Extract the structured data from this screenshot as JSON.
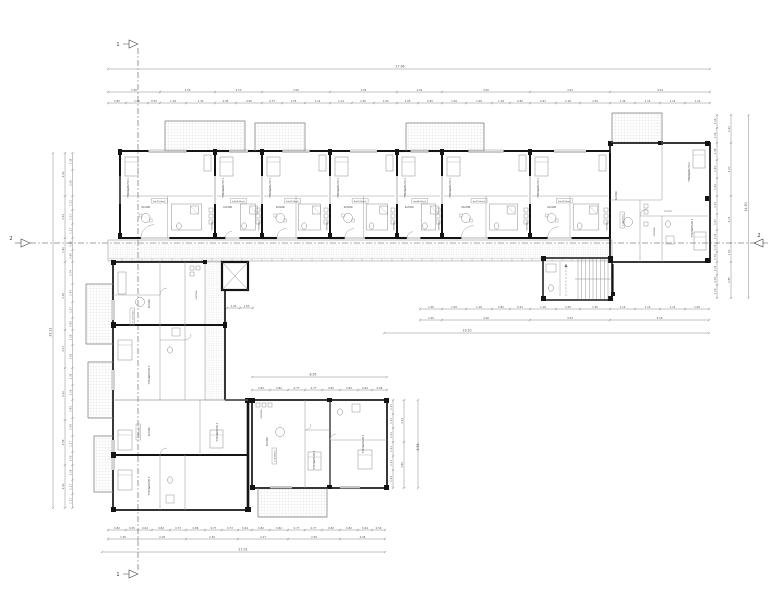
{
  "title": "apartment-building-floor-plan",
  "colors": {
    "wall": "#141414",
    "line": "#8b8b8b",
    "thin": "#ababab",
    "hatch": "#c9c9c9",
    "dim": "#7a7a7a",
    "dim_text": "#555555",
    "label": "#3f3f3f",
    "section": "#444444",
    "bg": "#ffffff"
  },
  "markers": {
    "section1": "1",
    "section2": "2"
  },
  "rooms": {
    "bedroom1": "ΥΠΝΟΔΩΜΑΤΙΟ 1",
    "bedroom2": "ΥΠΝΟΔΩΜΑΤΙΟ 2",
    "living": "ΣΑΛΟΝΙ",
    "kitchen": "ΚΟΥΖΙΝΑ",
    "bath": "ΛΟΥΤΡΟ",
    "wc": "WC",
    "hall": "ΧΩΛ"
  },
  "top_units": [
    {
      "bedroom": "ΥΠΝΟΔΩΜΑΤΙΟ 1",
      "living": "ΣΑΛΟΝΙ",
      "kitchen": "ΚΟΥΖΙΝΑ",
      "area": "Ε=75.50m2"
    },
    {
      "bedroom": "ΥΠΝΟΔΩΜΑΤΙΟ 1",
      "living": "ΣΑΛΟΝΙ",
      "kitchen": "ΚΟΥΖΙΝΑ",
      "area": "Ε=58.35m2"
    },
    {
      "bedroom": "ΥΠΝΟΔΩΜΑΤΙΟ 1",
      "living": "ΣΑΛΟΝΙ",
      "kitchen": "ΚΟΥΖΙΝΑ",
      "area": "Ε=76.50m2"
    },
    {
      "bedroom": "ΥΠΝΟΔΩΜΑΤΙΟ 1",
      "living": "ΣΑΛΟΝΙ",
      "kitchen": "ΚΟΥΖΙΝΑ",
      "area": "Ε=76.50m2"
    },
    {
      "bedroom": "ΥΠΝΟΔΩΜΑΤΙΟ 1",
      "living": "ΣΑΛΟΝΙ",
      "kitchen": "ΚΟΥΖΙΝΑ",
      "area": "Ε=58.35m2"
    },
    {
      "bedroom": "ΥΠΝΟΔΩΜΑΤΙΟ 1",
      "living": "ΣΑΛΟΝΙ",
      "kitchen": "ΚΟΥΖΙΝΑ",
      "area": "Ε=75.50m2"
    },
    {
      "bedroom": "ΥΠΝΟΔΩΜΑΤΙΟ 1",
      "living": "ΣΑΛΟΝΙ",
      "kitchen": "ΚΟΥΖΙΝΑ",
      "area": "Ε=76.50m2"
    }
  ],
  "right_unit": {
    "bedroom1": "ΥΠΝΟΔΩΜΑΤΙΟ 1",
    "bedroom2": "ΥΠΝΟΔΩΜΑΤΙΟ 2",
    "living": "ΣΑΛΟΝΙ",
    "kitchen": "ΚΟΥΖΙΝΑ",
    "bath": "ΛΟΥΤΡΟ",
    "area": "Ε=80.50m2"
  },
  "left_units": [
    {
      "living": "ΣΑΛΟΝΙ",
      "kitchen": "ΚΟΥΖΙΝΑ",
      "bedroom": "ΥΠΝΟΔΩΜΑΤΙΟ 1",
      "area": "Ε=103.05m2"
    },
    {
      "living": "ΣΑΛΟΝΙ",
      "bedroom1": "ΥΠΝΟΔΩΜΑΤΙΟ 1",
      "bedroom2": "ΥΠΝΟΔΩΜΑΤΙΟ 2",
      "area": "Ε=96.20m2"
    }
  ],
  "bottom_unit": {
    "living": "ΣΑΛΟΝΙ",
    "kitchen": "ΚΟΥΖΙΝΑ",
    "bedroom1": "ΥΠΝΟΔΩΜΑΤΙΟ 1",
    "bedroom2": "ΥΠΝΟΔΩΜΑΤΙΟ 2",
    "area": "Ε=84.60m2"
  },
  "overall_dims": {
    "top": "27.96",
    "left": "28.11",
    "right": "14.50",
    "mid": "19.10",
    "bottom": "21.02",
    "wing_top": "8.95",
    "wing_right": "6.98"
  },
  "dims": {
    "top_major": [
      "2.36",
      "2.50",
      "2.13",
      "3.09",
      "3.04",
      "2.04",
      "4.00",
      "3.63",
      "4.54"
    ],
    "top_minor": [
      "0.82",
      "1.00",
      "0.55",
      "1.18",
      "1.32",
      "0.95",
      "0.95",
      "0.73",
      "1.05",
      "1.14",
      "1.14",
      "1.00",
      "1.00",
      "1.05",
      "0.95",
      "1.09",
      "1.09",
      "1.18",
      "0.82",
      "0.91",
      "1.18",
      "1.09",
      "1.36",
      "1.14",
      "1.14",
      "1.14"
    ],
    "left_major": [
      "3.40",
      "3.33",
      "1.90",
      "5.39",
      "3.01",
      "4.12",
      "3.56",
      "3.40"
    ],
    "left_minor": [
      "1.35",
      "2.06",
      "1.11",
      "1.11",
      "1.11",
      "0.95",
      "0.95",
      "1.74",
      "1.43",
      "1.27",
      "0.95",
      "1.19",
      "1.82",
      "1.35",
      "1.19",
      "1.43",
      "1.43",
      "1.27",
      "1.03",
      "1.19",
      "1.11",
      "1.11"
    ],
    "right_major": [
      "2.22",
      "4.20",
      "3.72",
      "1.50",
      "2.85"
    ],
    "right_minor": [
      "1.03",
      "1.19",
      "1.35",
      "1.43",
      "1.43",
      "1.43",
      "1.27",
      "1.03",
      "0.71",
      "0.79",
      "1.03",
      "0.79",
      "1.03"
    ],
    "mid_major": [
      "1.00",
      "4.00",
      "3.63",
      "4.50"
    ],
    "mid_minor": [
      "1.00",
      "1.09",
      "1.18",
      "0.82",
      "0.91",
      "1.18",
      "1.09",
      "1.36",
      "1.14",
      "1.14",
      "1.14",
      "1.09"
    ],
    "bottom_major": [
      "1.36",
      "2.18",
      "2.36",
      "2.27",
      "2.36",
      "2.04"
    ],
    "bottom_minor": [
      "0.82",
      "0.55",
      "0.64",
      "0.82",
      "0.73",
      "0.86",
      "0.77",
      "0.73",
      "0.64",
      "0.82",
      "0.82",
      "0.77",
      "0.77",
      "0.82",
      "0.82",
      "0.64",
      "0.59"
    ],
    "wing_top_minor": [
      "0.82",
      "0.82",
      "0.77",
      "0.77",
      "0.82",
      "0.82",
      "0.64",
      "0.68"
    ],
    "wing_right_major": [
      "3.33",
      "3.65"
    ],
    "wing_right_minor": [
      "1.11",
      "1.11",
      "1.11",
      "1.11",
      "1.11",
      "1.43"
    ],
    "elev_minor": [
      "1.03",
      "1.03"
    ]
  }
}
